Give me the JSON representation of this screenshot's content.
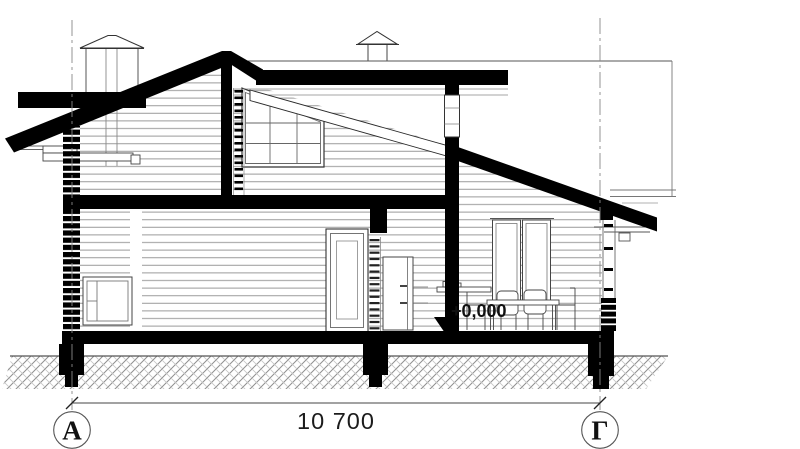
{
  "drawing": {
    "axes": {
      "left": {
        "label": "А"
      },
      "right": {
        "label": "Г"
      }
    },
    "dimension": {
      "label": "10 700"
    },
    "elevation": {
      "label": "+0,000"
    },
    "colors": {
      "ink": "#000000",
      "detail_line": "#444444",
      "siding_line": "#9a9a9a",
      "hatch_line": "#8f8f8f",
      "background": "#ffffff"
    }
  }
}
